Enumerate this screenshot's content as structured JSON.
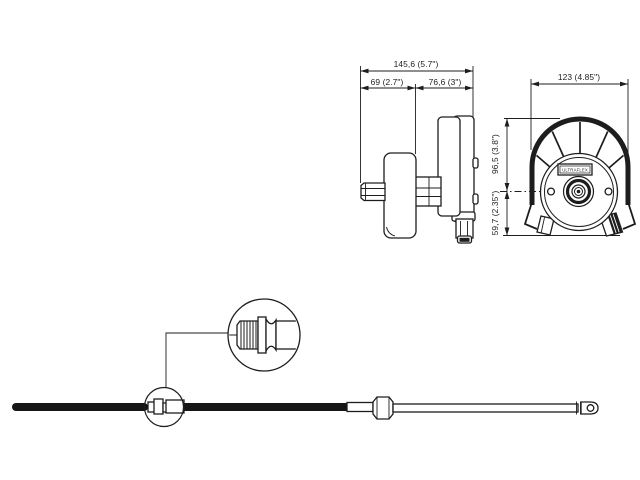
{
  "colors": {
    "background": "#ffffff",
    "ink": "#1d1d1d"
  },
  "side_view": {
    "dim_overall": "145,6 (5.7\")",
    "dim_front_section": "69 (2.7\")",
    "dim_rear_section": "76,6 (3\")"
  },
  "front_view": {
    "dim_width": "123 (4.85\")",
    "dim_above_centerline": "96,5 (3.8\")",
    "dim_below_centerline": "59,7 (2.35\")",
    "brand_label": "ULTRAFLEX"
  }
}
